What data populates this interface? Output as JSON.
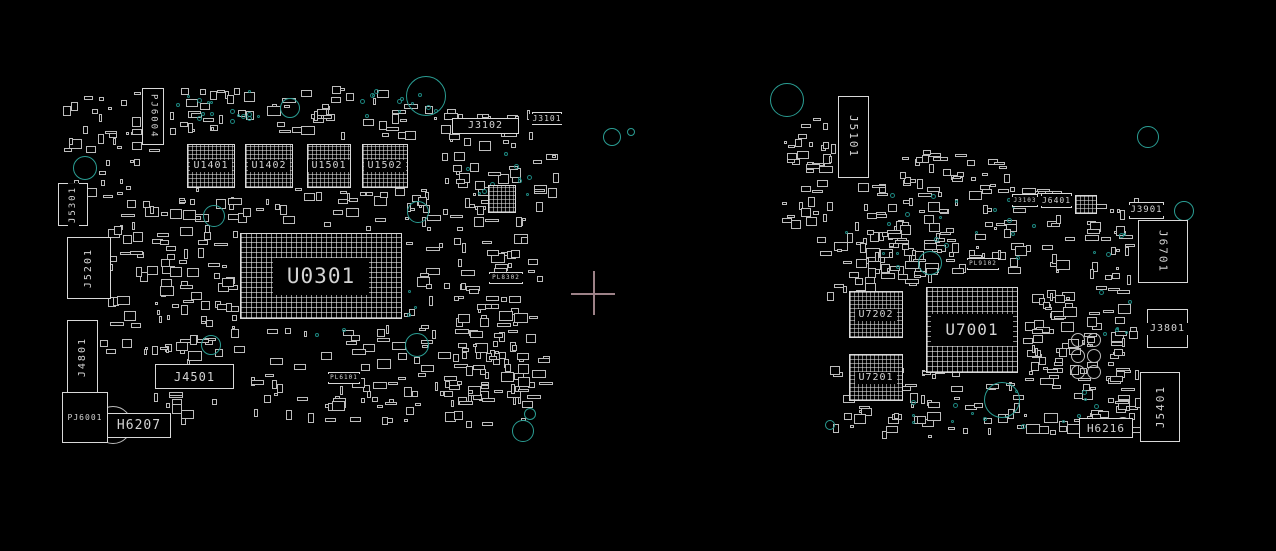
{
  "app": {
    "name": "boardview-canvas",
    "background": "#000000"
  },
  "colors": {
    "outline": "#d9d9d9",
    "label": "#d4d4d4",
    "teal": "#2a9d93",
    "teal_dim": "#1b7e78",
    "gray_ring": "#bdbdbd",
    "cross": "#9d8288"
  },
  "cross_marker": {
    "cx": 593,
    "cy": 293,
    "arm": 22
  },
  "boards": [
    {
      "name": "board-left",
      "components": [
        {
          "label": "PJ6004",
          "x": 142,
          "y": 88,
          "w": 22,
          "h": 57,
          "type": "connector",
          "vertical": true,
          "flip": false,
          "font": 9
        },
        {
          "label": "U1401",
          "x": 187,
          "y": 144,
          "w": 48,
          "h": 44,
          "type": "bga",
          "vertical": false,
          "flip": false,
          "font": 10
        },
        {
          "label": "U1402",
          "x": 245,
          "y": 144,
          "w": 48,
          "h": 44,
          "type": "bga",
          "vertical": false,
          "flip": false,
          "font": 10
        },
        {
          "label": "U1501",
          "x": 307,
          "y": 144,
          "w": 44,
          "h": 44,
          "type": "bga",
          "vertical": false,
          "flip": false,
          "font": 10
        },
        {
          "label": "U1502",
          "x": 362,
          "y": 144,
          "w": 46,
          "h": 44,
          "type": "bga",
          "vertical": false,
          "flip": false,
          "font": 10
        },
        {
          "label": "U0301",
          "x": 240,
          "y": 233,
          "w": 162,
          "h": 86,
          "type": "bga-large",
          "vertical": false,
          "flip": false,
          "font": 21
        },
        {
          "label": "J3102",
          "x": 452,
          "y": 118,
          "w": 67,
          "h": 16,
          "type": "connector",
          "vertical": false,
          "flip": false,
          "font": 10
        },
        {
          "label": "J3101",
          "x": 532,
          "y": 112,
          "w": 30,
          "h": 13,
          "type": "connector",
          "vertical": false,
          "flip": false,
          "font": 8
        },
        {
          "label": "J5301",
          "x": 58,
          "y": 183,
          "w": 30,
          "h": 43,
          "type": "connector",
          "vertical": true,
          "flip": true,
          "font": 9
        },
        {
          "label": "J5201",
          "x": 67,
          "y": 237,
          "w": 44,
          "h": 62,
          "type": "connector",
          "vertical": true,
          "flip": true,
          "font": 10
        },
        {
          "label": "J4801",
          "x": 67,
          "y": 320,
          "w": 31,
          "h": 74,
          "type": "connector",
          "vertical": true,
          "flip": true,
          "font": 10
        },
        {
          "label": "J4501",
          "x": 155,
          "y": 364,
          "w": 79,
          "h": 25,
          "type": "connector",
          "vertical": false,
          "flip": false,
          "font": 12
        },
        {
          "label": "PJ6001",
          "x": 62,
          "y": 392,
          "w": 46,
          "h": 51,
          "type": "connector",
          "vertical": false,
          "flip": false,
          "font": 8
        },
        {
          "label": "H6207",
          "x": 107,
          "y": 413,
          "w": 64,
          "h": 25,
          "type": "connector",
          "vertical": false,
          "flip": false,
          "font": 13
        },
        {
          "label": "PL6101",
          "x": 328,
          "y": 372,
          "w": 32,
          "h": 12,
          "type": "connector",
          "vertical": false,
          "flip": false,
          "font": 6
        },
        {
          "label": "PL8302",
          "x": 489,
          "y": 272,
          "w": 34,
          "h": 12,
          "type": "connector",
          "vertical": false,
          "flip": false,
          "font": 6
        },
        {
          "label": "",
          "x": 488,
          "y": 185,
          "w": 28,
          "h": 28,
          "type": "bga",
          "vertical": false,
          "flip": false,
          "font": 6
        }
      ],
      "circles": [
        {
          "x": 426,
          "y": 96,
          "r": 20,
          "color": "teal"
        },
        {
          "x": 290,
          "y": 108,
          "r": 10,
          "color": "teal"
        },
        {
          "x": 85,
          "y": 168,
          "r": 12,
          "color": "teal"
        },
        {
          "x": 214,
          "y": 216,
          "r": 11,
          "color": "teal"
        },
        {
          "x": 418,
          "y": 212,
          "r": 11,
          "color": "teal"
        },
        {
          "x": 211,
          "y": 345,
          "r": 10,
          "color": "teal"
        },
        {
          "x": 417,
          "y": 345,
          "r": 12,
          "color": "teal"
        },
        {
          "x": 530,
          "y": 414,
          "r": 6,
          "color": "teal"
        },
        {
          "x": 523,
          "y": 431,
          "r": 11,
          "color": "teal"
        },
        {
          "x": 612,
          "y": 137,
          "r": 9,
          "color": "teal"
        },
        {
          "x": 631,
          "y": 132,
          "r": 4,
          "color": "teal"
        },
        {
          "x": 113,
          "y": 425,
          "r": 19,
          "color": "gray"
        }
      ],
      "clusters": [
        {
          "x": 168,
          "y": 86,
          "w": 270,
          "h": 55,
          "n": 60,
          "seed": 11
        },
        {
          "x": 60,
          "y": 92,
          "w": 105,
          "h": 110,
          "n": 40,
          "seed": 12
        },
        {
          "x": 440,
          "y": 105,
          "w": 120,
          "h": 100,
          "n": 48,
          "seed": 13
        },
        {
          "x": 100,
          "y": 198,
          "w": 140,
          "h": 165,
          "n": 95,
          "seed": 14
        },
        {
          "x": 170,
          "y": 188,
          "w": 268,
          "h": 44,
          "n": 42,
          "seed": 15
        },
        {
          "x": 404,
          "y": 198,
          "w": 140,
          "h": 145,
          "n": 75,
          "seed": 16
        },
        {
          "x": 140,
          "y": 325,
          "w": 400,
          "h": 105,
          "n": 120,
          "seed": 17
        },
        {
          "x": 440,
          "y": 340,
          "w": 120,
          "h": 70,
          "n": 40,
          "seed": 18
        }
      ],
      "dot_clusters": [
        {
          "x": 172,
          "y": 90,
          "w": 95,
          "h": 35,
          "n": 16,
          "seed": 31
        },
        {
          "x": 350,
          "y": 86,
          "w": 90,
          "h": 35,
          "n": 12,
          "seed": 32
        },
        {
          "x": 455,
          "y": 145,
          "w": 90,
          "h": 60,
          "n": 14,
          "seed": 33
        },
        {
          "x": 300,
          "y": 290,
          "w": 120,
          "h": 60,
          "n": 10,
          "seed": 34
        }
      ]
    },
    {
      "name": "board-right",
      "components": [
        {
          "label": "J5101",
          "x": 838,
          "y": 96,
          "w": 31,
          "h": 82,
          "type": "connector",
          "vertical": true,
          "flip": false,
          "font": 11
        },
        {
          "label": "J3103",
          "x": 1012,
          "y": 194,
          "w": 26,
          "h": 13,
          "type": "connector",
          "vertical": false,
          "flip": false,
          "font": 6
        },
        {
          "label": "J6401",
          "x": 1041,
          "y": 193,
          "w": 31,
          "h": 15,
          "type": "connector",
          "vertical": false,
          "flip": false,
          "font": 8
        },
        {
          "label": "J3901",
          "x": 1129,
          "y": 202,
          "w": 35,
          "h": 17,
          "type": "connector",
          "vertical": false,
          "flip": false,
          "font": 9
        },
        {
          "label": "J6701",
          "x": 1138,
          "y": 220,
          "w": 50,
          "h": 63,
          "type": "connector",
          "vertical": true,
          "flip": false,
          "font": 11
        },
        {
          "label": "U7202",
          "x": 849,
          "y": 291,
          "w": 54,
          "h": 47,
          "type": "bga",
          "vertical": false,
          "flip": false,
          "font": 10
        },
        {
          "label": "U7201",
          "x": 849,
          "y": 354,
          "w": 54,
          "h": 47,
          "type": "bga",
          "vertical": false,
          "flip": false,
          "font": 10
        },
        {
          "label": "U7001",
          "x": 926,
          "y": 287,
          "w": 92,
          "h": 86,
          "type": "bga-large",
          "vertical": false,
          "flip": false,
          "font": 16
        },
        {
          "label": "J3801",
          "x": 1147,
          "y": 309,
          "w": 41,
          "h": 39,
          "type": "connector",
          "vertical": false,
          "flip": false,
          "font": 10
        },
        {
          "label": "J5401",
          "x": 1140,
          "y": 372,
          "w": 40,
          "h": 70,
          "type": "connector",
          "vertical": true,
          "flip": true,
          "font": 11
        },
        {
          "label": "H6216",
          "x": 1079,
          "y": 418,
          "w": 54,
          "h": 20,
          "type": "connector",
          "vertical": false,
          "flip": false,
          "font": 11
        },
        {
          "label": "PL9102",
          "x": 967,
          "y": 258,
          "w": 32,
          "h": 12,
          "type": "connector",
          "vertical": false,
          "flip": false,
          "font": 6
        },
        {
          "label": "",
          "x": 1075,
          "y": 195,
          "w": 22,
          "h": 19,
          "type": "bga",
          "vertical": false,
          "flip": false,
          "font": 6
        }
      ],
      "circles": [
        {
          "x": 787,
          "y": 100,
          "r": 17,
          "color": "teal"
        },
        {
          "x": 1148,
          "y": 137,
          "r": 11,
          "color": "teal"
        },
        {
          "x": 1184,
          "y": 211,
          "r": 10,
          "color": "teal"
        },
        {
          "x": 930,
          "y": 263,
          "r": 12,
          "color": "teal"
        },
        {
          "x": 1002,
          "y": 400,
          "r": 18,
          "color": "teal"
        },
        {
          "x": 830,
          "y": 425,
          "r": 5,
          "color": "teal"
        },
        {
          "x": 1123,
          "y": 425,
          "r": 8,
          "color": "gray"
        },
        {
          "x": 1078,
          "y": 340,
          "r": 7,
          "color": "gray"
        },
        {
          "x": 1094,
          "y": 340,
          "r": 7,
          "color": "gray"
        },
        {
          "x": 1078,
          "y": 356,
          "r": 7,
          "color": "gray"
        },
        {
          "x": 1094,
          "y": 356,
          "r": 7,
          "color": "gray"
        },
        {
          "x": 1078,
          "y": 372,
          "r": 7,
          "color": "gray"
        },
        {
          "x": 1094,
          "y": 372,
          "r": 7,
          "color": "gray"
        }
      ],
      "clusters": [
        {
          "x": 778,
          "y": 118,
          "w": 60,
          "h": 115,
          "n": 38,
          "seed": 21
        },
        {
          "x": 855,
          "y": 180,
          "w": 225,
          "h": 105,
          "n": 110,
          "seed": 22
        },
        {
          "x": 1082,
          "y": 195,
          "w": 58,
          "h": 180,
          "n": 48,
          "seed": 23
        },
        {
          "x": 815,
          "y": 228,
          "w": 115,
          "h": 75,
          "n": 40,
          "seed": 24
        },
        {
          "x": 820,
          "y": 365,
          "w": 320,
          "h": 75,
          "n": 90,
          "seed": 25
        },
        {
          "x": 1020,
          "y": 290,
          "w": 62,
          "h": 85,
          "n": 38,
          "seed": 26
        },
        {
          "x": 900,
          "y": 150,
          "w": 120,
          "h": 45,
          "n": 30,
          "seed": 27
        },
        {
          "x": 1085,
          "y": 395,
          "w": 60,
          "h": 45,
          "n": 20,
          "seed": 28
        }
      ],
      "dot_clusters": [
        {
          "x": 845,
          "y": 190,
          "w": 200,
          "h": 90,
          "n": 20,
          "seed": 41
        },
        {
          "x": 1090,
          "y": 230,
          "w": 60,
          "h": 120,
          "n": 10,
          "seed": 42
        },
        {
          "x": 900,
          "y": 380,
          "w": 200,
          "h": 50,
          "n": 14,
          "seed": 43
        }
      ]
    }
  ]
}
